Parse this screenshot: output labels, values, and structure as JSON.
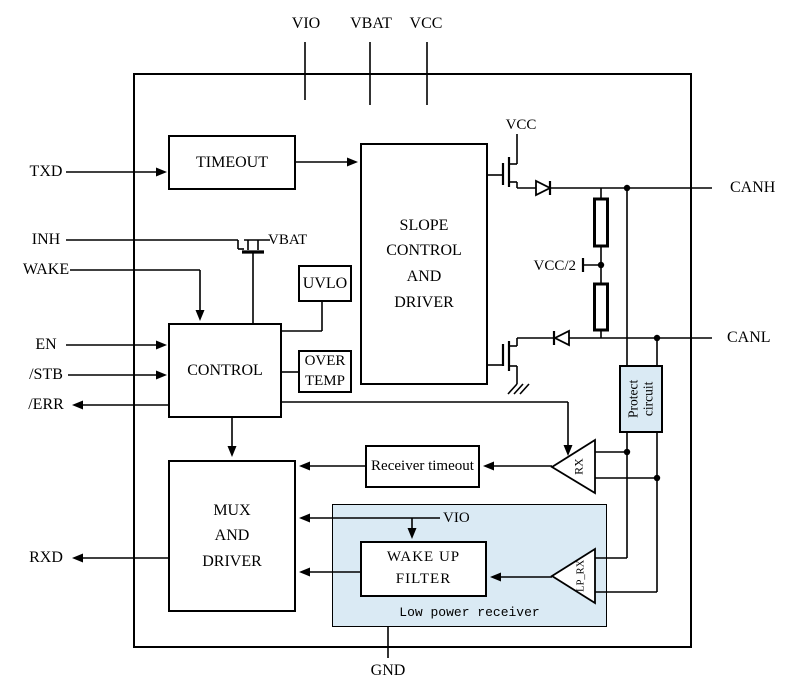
{
  "diagram": {
    "top_pins": {
      "vio": "VIO",
      "vbat": "VBAT",
      "vcc": "VCC"
    },
    "left_pins": {
      "txd": "TXD",
      "inh": "INH",
      "wake": "WAKE",
      "en": "EN",
      "stb": "/STB",
      "err": "/ERR",
      "rxd": "RXD"
    },
    "right_pins": {
      "canh": "CANH",
      "canl": "CANL"
    },
    "bottom_pins": {
      "gnd": "GND"
    },
    "blocks": {
      "timeout": "TIMEOUT",
      "slope": "SLOPE\nCONTROL\nAND\nDRIVER",
      "uvlo": "UVLO",
      "control": "CONTROL",
      "over_temp": "OVER\nTEMP",
      "receiver_timeout": "Receiver timeout",
      "mux": "MUX\nAND\nDRIVER",
      "wake_up_filter": "WAKE UP FILTER",
      "low_power_receiver": "Low power receiver",
      "protect_circuit": "Protect\ncircuit",
      "rx": "RX",
      "lp_rx": "LP_RX"
    },
    "net_labels": {
      "vbat_internal": "VBAT",
      "vcc_internal": "VCC",
      "vcc_half": "VCC/2",
      "vio_internal": "VIO"
    },
    "colors": {
      "line": "#000000",
      "shaded_fill": "#daeaf4",
      "background": "#ffffff"
    }
  }
}
